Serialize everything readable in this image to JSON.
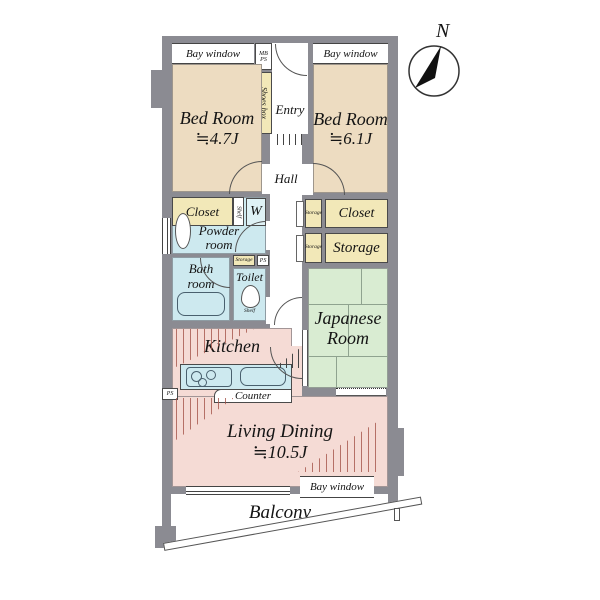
{
  "colors": {
    "wall": "#8b8b92",
    "bedroom": "#eddcc1",
    "wet_area": "#cde9ef",
    "storage": "#f2e8b8",
    "tatami": "#d9ecd2",
    "living": "#f5dbd5",
    "line": "#444444"
  },
  "compass": {
    "north": "N"
  },
  "rooms": {
    "bedroom1": {
      "name": "Bed Room",
      "size": "≒4.7J"
    },
    "bedroom2": {
      "name": "Bed Room",
      "size": "≒6.1J"
    },
    "japanese_room": {
      "line1": "Japanese",
      "line2": "Room"
    },
    "living_dining": {
      "name": "Living Dining",
      "size": "≒10.5J"
    },
    "kitchen": {
      "name": "Kitchen"
    },
    "powder_room": {
      "line1": "Powder",
      "line2": "room"
    },
    "bath_room": {
      "line1": "Bath",
      "line2": "room"
    },
    "toilet": {
      "name": "Toilet"
    },
    "entry": {
      "name": "Entry"
    },
    "hall": {
      "name": "Hall"
    },
    "balcony": {
      "name": "Balcony"
    }
  },
  "fixtures": {
    "bay_window_top_left": "Bay window",
    "bay_window_top_right": "Bay window",
    "bay_window_bottom": "Bay window",
    "shoes_box": "Shoes box",
    "meter_box": "MB",
    "pipe_space_entry": "PS",
    "closet_left": "Closet",
    "shelf_left": "Shelf",
    "washing_machine": "W",
    "storage_mini": "Storage",
    "pipe_space_mid": "PS",
    "toilet_shelf": "Shelf",
    "storage_small_upper": "Storage",
    "storage_small_lower": "Storage",
    "closet_right": "Closet",
    "storage_right": "Storage",
    "counter": "Counter",
    "pipe_space_kitchen": "PS"
  }
}
